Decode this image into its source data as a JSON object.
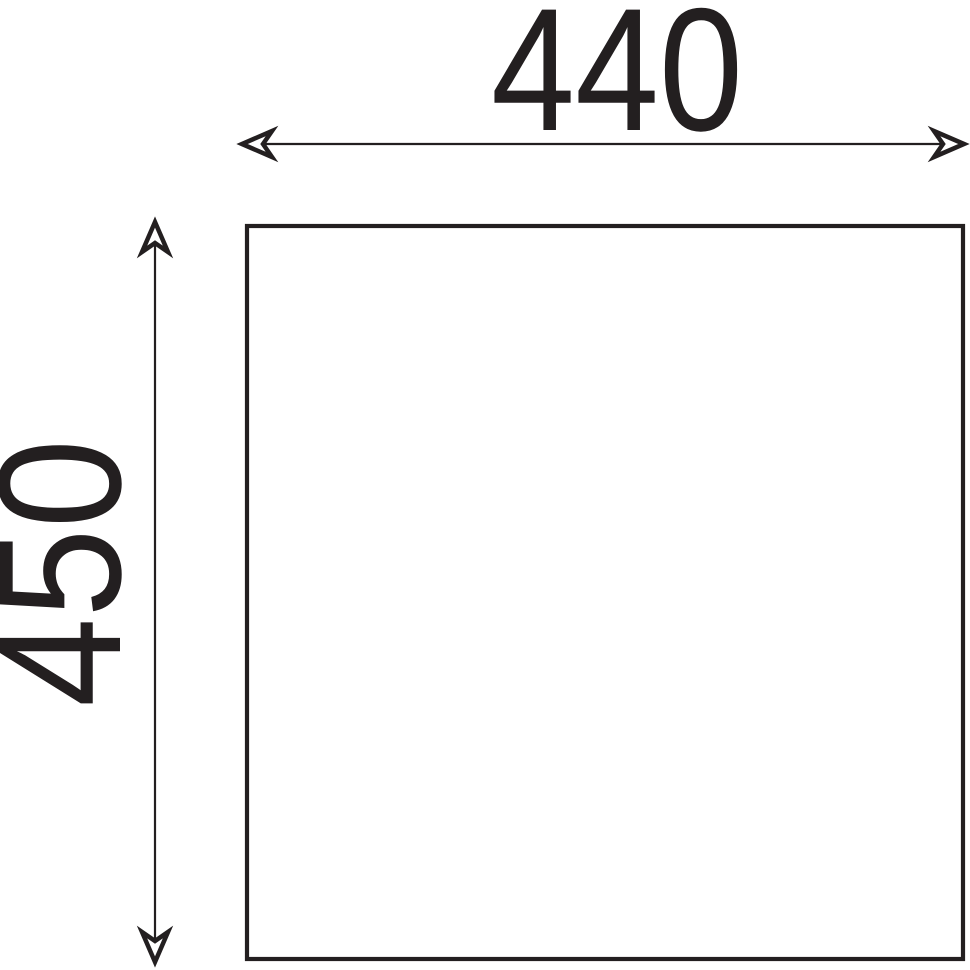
{
  "drawing": {
    "type": "technical-dimension-drawing",
    "horizontal_dimension": {
      "value": "440"
    },
    "vertical_dimension": {
      "value": "450"
    },
    "line_color": "#231f20",
    "background_color": "#ffffff"
  }
}
